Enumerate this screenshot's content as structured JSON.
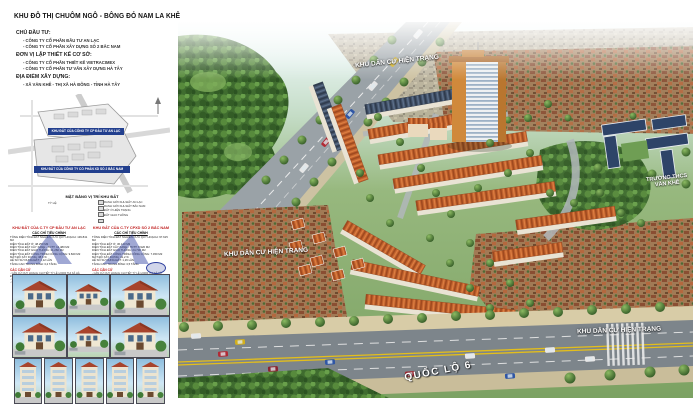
{
  "colors": {
    "banner_blue": "#223f8e",
    "heading_red": "#c01f1f",
    "roof_orange": "#c2622d",
    "roof_navy": "#2e4468",
    "forest_green": "#3f6c2f",
    "highway_grey": "#7d858b",
    "label_white": "#ffffff"
  },
  "poster": {
    "title": "KHU ĐÔ THỊ CHUÔM NGÔ - BÔNG ĐỎ NAM LA KHÊ",
    "info": {
      "investor_heading": "CHỦ ĐẦU TƯ:",
      "investors": [
        "- CÔNG TY CỔ PHẦN ĐẦU TƯ AN LẠC",
        "- CÔNG TY CỔ PHẦN XÂY DỰNG SỐ 2 BẮC NAM"
      ],
      "designer_heading": "ĐƠN VỊ LẬP THIẾT KẾ CƠ SỞ:",
      "designers": [
        "- CÔNG TY CỔ PHẦN THIẾT KẾ VIETRACIMEX",
        "- CÔNG TY CỔ PHẦN TƯ VẤN XÂY DỰNG HÀ TÂY"
      ],
      "location_heading": "ĐỊA ĐIỂM XÂY DỰNG:",
      "location": "- XÃ VĂN KHÊ - THỊ XÃ HÀ ĐÔNG - TỈNH HÀ TÂY"
    },
    "site_plan": {
      "banner_anlac": "KHU ĐẤT CỦA CÔNG TY CP ĐẦU TƯ AN LẠC",
      "banner_bacnam": "KHU ĐẤT CỦA CÔNG TY CỔ PHẦN XD SỐ 2 BẮC NAM",
      "caption": "MẶT BẰNG VỊ TRÍ KHU ĐẤT",
      "scale_note": "TỶ LỆ:",
      "legend": "RANH GIỚI KHU ĐẤT AN LẠC\nRANH GIỚI KHU ĐẤT BẮC NAM\nĐẤT Ở HIỆN TRẠNG\nĐẤT GIAO THÔNG"
    },
    "stats_anlac": {
      "heading": "KHU ĐẤT CỦA C.TY CP ĐẦU TƯ AN LẠC",
      "subheading": "CÁC CHỈ TIÊU CHÍNH",
      "rows": "TỔNG DIỆN TÍCH ĐẤT NGHIÊN CỨU QUY HOẠCH: 139.841 M2\nDIỆN TÍCH ĐẤT Ở: 48.250 M2\nDIỆN TÍCH ĐẤT CÂY XANH - TDTT: 12.480 M2\nDIỆN TÍCH ĐẤT GIAO THÔNG: 31.260 M2\nDIỆN TÍCH ĐẤT CÔNG TRÌNH CÔNG CỘNG: 9.820 M2\nMẬT ĐỘ XÂY DỰNG: 38,6 %\nHỆ SỐ SỬ DỤNG ĐẤT: 1,12 LẦN\nTẦNG CAO TRUNG BÌNH: 3,2 TẦNG",
      "basis_heading": "CÁC CĂN CỨ",
      "basis_text": "- CĂN CỨ QUY HOẠCH CHI TIẾT TỶ LỆ 1/2000 THỊ XÃ HÀ ĐÔNG\n- CĂN CỨ QUYẾT ĐỊNH GIAO ĐẤT CỦA UBND TỈNH HÀ TÂY\n- CĂN CỨ TIÊU CHUẨN QUY PHẠM XÂY DỰNG VIỆT NAM"
    },
    "stats_bacnam": {
      "heading": "KHU ĐẤT CỦA C.TY CPXD SỐ 2 BẮC NAM",
      "subheading": "CÁC CHỈ TIÊU CHÍNH",
      "rows": "TỔNG DIỆN TÍCH ĐẤT NGHIÊN CỨU QUY HOẠCH: 97.615 M2\nDIỆN TÍCH ĐẤT Ở: 36.140 M2\nDIỆN TÍCH ĐẤT CÂY XANH - TDTT: 8.920 M2\nDIỆN TÍCH ĐẤT GIAO THÔNG: 24.730 M2\nDIỆN TÍCH ĐẤT CÔNG TRÌNH CÔNG CỘNG: 7.450 M2\nMẬT ĐỘ XÂY DỰNG: 41,2 %\nHỆ SỐ SỬ DỤNG ĐẤT: 1,26 LẦN\nTẦNG CAO TRUNG BÌNH: 3,5 TẦNG",
      "basis_heading": "CÁC CĂN CỨ",
      "basis_text": "- CĂN CỨ QUY HOẠCH CHI TIẾT TỶ LỆ 1/2000 THỊ XÃ HÀ ĐÔNG\n- CĂN CỨ QUYẾT ĐỊNH GIAO ĐẤT CỦA UBND TỈNH HÀ TÂY\n- CĂN CỨ TIÊU CHUẨN QUY PHẠM XÂY DỰNG VIỆT NAM"
    },
    "rendering": {
      "labels": [
        {
          "text": "KHU DÂN CƯ HIỆN TRẠNG"
        },
        {
          "text": "KHU DÂN CƯ HIỆN TRẠNG"
        },
        {
          "text": "KHU DÂN CƯ HIỆN TRẠNG"
        },
        {
          "text": "TRƯỜNG THCS VĂN KHÊ"
        },
        {
          "text": "QUỐC LỘ 6"
        }
      ]
    }
  }
}
